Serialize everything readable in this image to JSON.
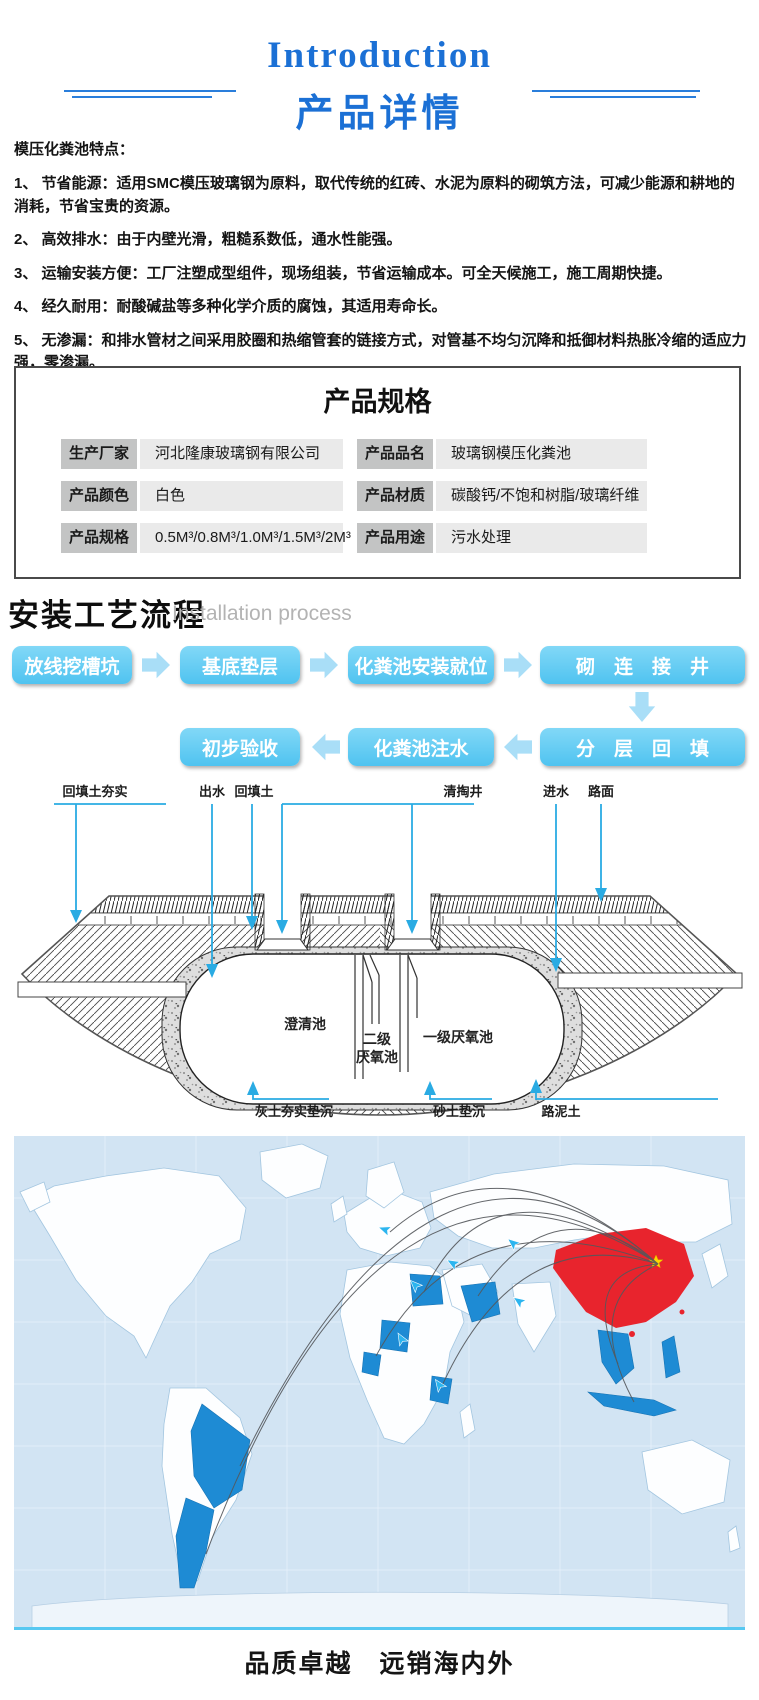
{
  "header": {
    "title_en": "Introduction",
    "title_zh": "产品详情"
  },
  "features": {
    "heading": "模压化粪池特点：",
    "items": [
      "1、 节省能源：适用SMC模压玻璃钢为原料，取代传统的红砖、水泥为原料的砌筑方法，可减少能源和耕地的消耗，节省宝贵的资源。",
      "2、 高效排水：由于内壁光滑，粗糙系数低，通水性能强。",
      "3、 运输安装方便：工厂注塑成型组件，现场组装，节省运输成本。可全天候施工，施工周期快捷。",
      "4、 经久耐用：耐酸碱盐等多种化学介质的腐蚀，其适用寿命长。",
      "5、 无渗漏：和排水管材之间采用胶圈和热缩管套的链接方式，对管基不均匀沉降和抵御材料热胀冷缩的适应力强，零渗漏。",
      "6、 适配性强：可任意调节井筒高度，满足工程安装及各方来水的一切需求。"
    ]
  },
  "spec": {
    "title": "产品规格",
    "cells": [
      {
        "label": "生产厂家",
        "value": "河北隆康玻璃钢有限公司"
      },
      {
        "label": "产品品名",
        "value": "玻璃钢模压化粪池"
      },
      {
        "label": "产品颜色",
        "value": "白色"
      },
      {
        "label": "产品材质",
        "value": "碳酸钙/不饱和树脂/玻璃纤维"
      },
      {
        "label": "产品规格",
        "value": "0.5M³/0.8M³/1.0M³/1.5M³/2M³"
      },
      {
        "label": "产品用途",
        "value": "污水处理"
      }
    ]
  },
  "process": {
    "title_zh": "安装工艺流程",
    "title_en": "Installation process",
    "steps_row1": [
      "放线挖槽坑",
      "基底垫层",
      "化粪池安装就位",
      "砌　连　接　井"
    ],
    "steps_row2": [
      "初步验收",
      "化粪池注水",
      "分　层　回　填"
    ]
  },
  "diagram": {
    "labels_top": [
      "回填土夯实",
      "出水",
      "回填土",
      "清掏井",
      "进水",
      "路面"
    ],
    "labels_tank": {
      "clarify": "澄清池",
      "second_l1": "二级",
      "second_l2": "厌氧池",
      "first": "一级厌氧池"
    },
    "labels_bottom": [
      "灰土夯实垫沉",
      "砂土垫沉",
      "路泥土"
    ]
  },
  "footer": {
    "caption": "品质卓越　远销海内外"
  },
  "colors": {
    "accent_blue": "#1b70d5",
    "flow_box_blue": "#5fcbf3",
    "flow_arrow_blue": "#a9def7",
    "leader_blue": "#2aabe3",
    "map_ocean": "#d2e4f3",
    "map_highlight": "#1e8bd4",
    "map_china_red": "#e8242d",
    "star_yellow": "#ffd800"
  }
}
